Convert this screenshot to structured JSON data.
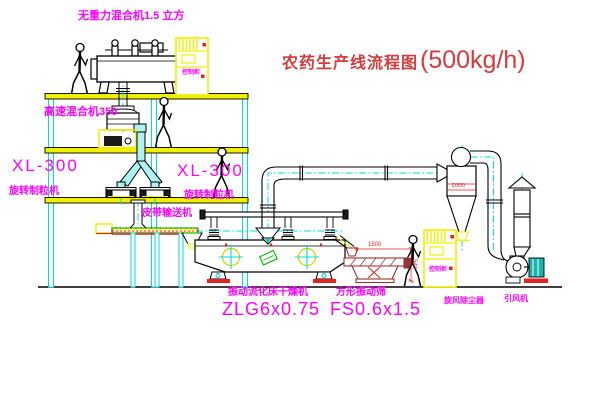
{
  "title": {
    "text": "农药生产线流程图",
    "capacity": "(500kg/h)"
  },
  "equipment_labels": {
    "gravity_mixer": "无重力混合机1.5 立方",
    "high_speed_mixer": "高速混合机350",
    "granulator_left": {
      "model": "XL-300",
      "name": "旋转制粒机"
    },
    "granulator_right": {
      "model": "XL-300",
      "name": "旋转制粒机"
    },
    "belt_conveyor": "皮带输送机",
    "fluid_bed_dryer": {
      "name": "振动流化床干燥机",
      "model": "ZLG6x0.75"
    },
    "vibrating_sieve": {
      "name": "方形振动筛",
      "model": "FS0.6x1.5"
    },
    "cyclone": "旋风除尘器",
    "induced_draft_fan": "引风机",
    "control_cabinet": "控制柜"
  },
  "dimensions": {
    "sieve_length": "1500",
    "sieve_outlet_height": "540",
    "cyclone_marking": "D300"
  },
  "colors": {
    "label_magenta": "#ff00ff",
    "title_red": "#d43c3c",
    "structure_yellow": "#f0f000",
    "centerline_cyan": "#00dddd",
    "conveyor_green": "#00cc00",
    "alert_red": "#e32222",
    "motor_teal": "#19b5ad",
    "sieve_dark_red": "#993333"
  }
}
